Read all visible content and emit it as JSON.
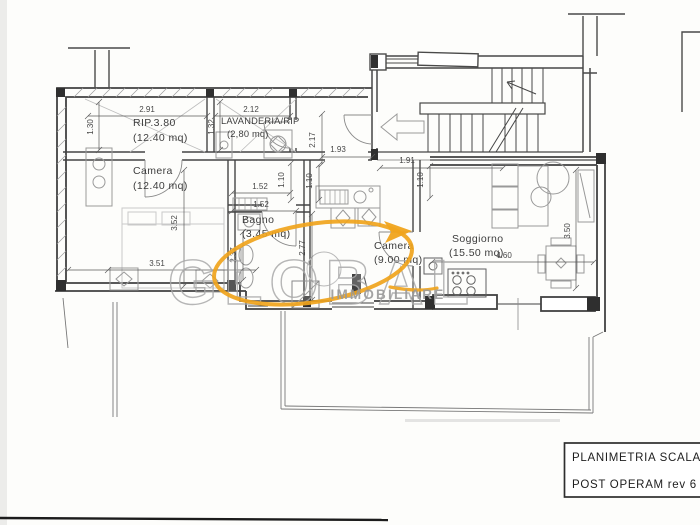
{
  "page": {
    "background": "#fdfdfb"
  },
  "watermark": {
    "brand": "GLOBAL",
    "subtitle": "IMMOBILIARE",
    "accent_color": "#f0a41c",
    "text_color": "#aaaaaa"
  },
  "title_block": {
    "line1": "PLANIMETRIA SCALA 1:",
    "line2": "POST OPERAM rev 6"
  },
  "rooms": {
    "rip": {
      "name": "RIP.3.80",
      "area": "(12.40 mq)"
    },
    "lavanderia": {
      "name": "LAVANDERIA/RIP",
      "area": "(2,80  mq)"
    },
    "camera1": {
      "name": "Camera",
      "area": "(12.40  mq)"
    },
    "bagno": {
      "name": "Bagno",
      "area": "(3.45  mq)"
    },
    "camera2": {
      "name": "Camera",
      "area": "(9.00  mq)"
    },
    "soggiorno": {
      "name": "Soggiorno",
      "area": "(15.50  mq)"
    }
  },
  "dimensions": {
    "rip_top": "2.91",
    "rip_left": "1.30",
    "lav_top": "2.12",
    "lav_left": "1.32",
    "cam1_height": "3.52",
    "cam1_width": "3.51",
    "bagno_top_a": "1.52",
    "bagno_top_b": "1.52",
    "bagno_side": "1.10",
    "bagno_height": "2.37",
    "hall_height": "2.17",
    "hall_width": "1.93",
    "hall_side": "1.10",
    "cam2_height": "2.77",
    "sog_top": "1.91",
    "sog_left": "1.10",
    "sog_right": "3.50",
    "sog_bottom": "4.60"
  }
}
